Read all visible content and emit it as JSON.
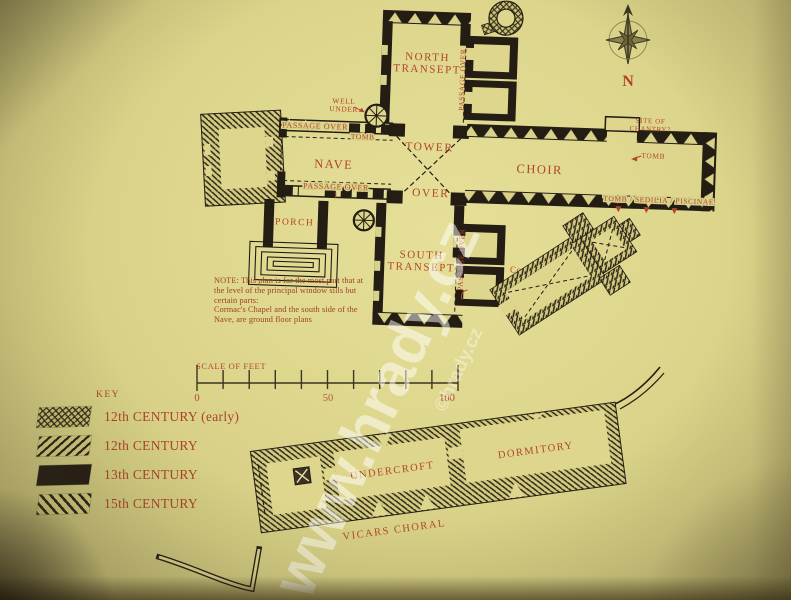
{
  "plan_title": "Cathedral floor plan",
  "rooms": {
    "north_transept_1": "NORTH",
    "north_transept_2": "TRANSEPT",
    "nave": "NAVE",
    "tower": "TOWER",
    "tower_over": "OVER",
    "choir": "CHOIR",
    "south_transept_1": "SOUTH",
    "south_transept_2": "TRANSEPT",
    "porch": "PORCH",
    "cormacs_chapel": "Cormac's Chapel",
    "undercroft": "UNDERCROFT",
    "dormitory": "DORMITORY",
    "vicars_choral": "VICARS CHORAL"
  },
  "annotations": {
    "passage_over": "PASSAGE OVER",
    "well_under_1": "WELL",
    "well_under_2": "UNDER",
    "tomb": "TOMB",
    "site_of_chantry_1": "SITE OF",
    "site_of_chantry_2": "CHANTRY?",
    "tomb_sedilia_piscinae": "TOMB / SEDILIA / PISCINAE"
  },
  "note": {
    "lines": [
      "NOTE: This plan is for the most part that at",
      "the level of the principal window sills but",
      "certain parts:",
      "Cormac's Chapel and the south side of the",
      "Nave,  are ground floor plans"
    ]
  },
  "scale": {
    "title": "SCALE OF FEET",
    "zero": "0",
    "mid": "50",
    "hundred": "100"
  },
  "key": {
    "title": "KEY",
    "items": [
      {
        "label": "12th CENTURY (early)",
        "pattern": "crosshatch"
      },
      {
        "label": "12th CENTURY",
        "pattern": "diagonal-up"
      },
      {
        "label": "13th CENTURY",
        "pattern": "solid"
      },
      {
        "label": "15th CENTURY",
        "pattern": "diagonal-down"
      }
    ]
  },
  "compass": {
    "north": "N"
  },
  "watermark": {
    "primary": "www.hrady.cz",
    "secondary": "©hrady.cz"
  },
  "colors": {
    "paper": "#ddd68c",
    "ink": "#241d14",
    "label_red": "#b2452b"
  }
}
